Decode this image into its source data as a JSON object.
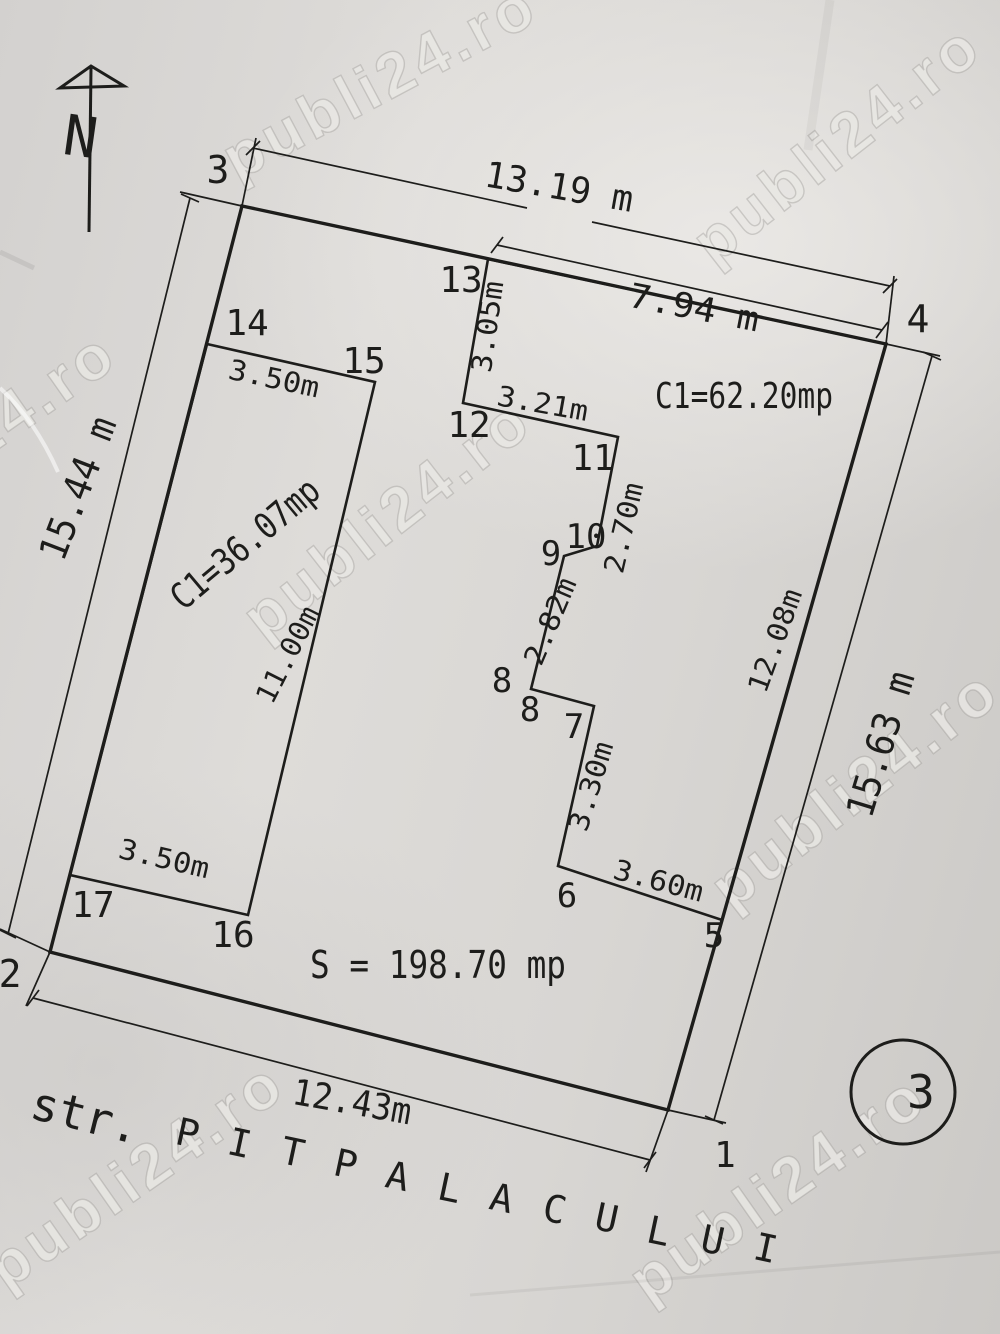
{
  "document_type": "cadastral site plan (scanned)",
  "colors": {
    "ink": "#1d1d1b",
    "paper": "#d8d6d3"
  },
  "watermark_text": "publi24.ro",
  "north_indicator": "N",
  "parcel": {
    "total_area_label": "S = 198.70 mp",
    "corner_numbers": [
      "1",
      "2",
      "3",
      "4"
    ],
    "side_dimensions": {
      "top": "13.19 m",
      "right": "15.63 m",
      "left": "15.44 m",
      "bottom": "12.43m"
    }
  },
  "buildings": [
    {
      "area_label": "C1=62.20mp",
      "corner_numbers": [
        "5",
        "6",
        "7",
        "8",
        "8",
        "9",
        "10",
        "11",
        "12",
        "13"
      ],
      "edge_dimensions": [
        "7.94 m",
        "12.08m",
        "3.60m",
        "3.30m",
        "2.82m",
        "2.70m",
        "3.21m",
        "3.05m"
      ]
    },
    {
      "area_label": "C1=36.07mp",
      "corner_numbers": [
        "14",
        "15",
        "16",
        "17"
      ],
      "edge_dimensions": [
        "3.50m",
        "11.00m",
        "3.50m"
      ]
    }
  ],
  "street": {
    "prefix": "str.",
    "name": "PITPALACULUI"
  },
  "sheet_number": "3",
  "street_letter_positions": [
    [
      185,
      1146
    ],
    [
      237,
      1156
    ],
    [
      290,
      1165
    ],
    [
      343,
      1177
    ],
    [
      395,
      1189
    ],
    [
      447,
      1201
    ],
    [
      499,
      1211
    ],
    [
      552,
      1222
    ],
    [
      604,
      1231
    ],
    [
      656,
      1244
    ],
    [
      710,
      1253
    ],
    [
      763,
      1261
    ]
  ],
  "street_letter_style": {
    "rot": 12,
    "size": 38
  },
  "annotations": [
    {
      "id": "north-letter",
      "t": "N",
      "x": 78,
      "y": 156,
      "r": 8,
      "s": 56
    },
    {
      "id": "corner-label-3",
      "t": "3",
      "x": 218,
      "y": 183,
      "r": 0,
      "s": 38
    },
    {
      "id": "dim-top",
      "t": "13.19 m",
      "x": 557,
      "y": 199,
      "r": 10,
      "s": 36,
      "tl": 150
    },
    {
      "id": "point-label-13",
      "t": "13",
      "x": 461,
      "y": 292,
      "r": 0,
      "s": 36
    },
    {
      "id": "dim-7-94",
      "t": "7.94 m",
      "x": 692,
      "y": 319,
      "r": 11,
      "s": 34,
      "tl": 132
    },
    {
      "id": "corner-label-4",
      "t": "4",
      "x": 918,
      "y": 332,
      "r": 0,
      "s": 38
    },
    {
      "id": "dim-3-05",
      "t": "3.05m",
      "x": 497,
      "y": 328,
      "r": -82,
      "s": 28,
      "tl": 92
    },
    {
      "id": "building-area-large",
      "t": "C1=62.20mp",
      "x": 744,
      "y": 408,
      "r": 0,
      "s": 36,
      "tl": 178
    },
    {
      "id": "point-label-12",
      "t": "12",
      "x": 469,
      "y": 437,
      "r": 0,
      "s": 36
    },
    {
      "id": "dim-3-21",
      "t": "3.21m",
      "x": 541,
      "y": 413,
      "r": 10,
      "s": 28,
      "tl": 92
    },
    {
      "id": "point-label-11",
      "t": "11",
      "x": 593,
      "y": 470,
      "r": 0,
      "s": 36
    },
    {
      "id": "dim-2-70",
      "t": "2.70m",
      "x": 633,
      "y": 530,
      "r": -77,
      "s": 28,
      "tl": 92
    },
    {
      "id": "point-label-10",
      "t": "10",
      "x": 586,
      "y": 548,
      "r": 0,
      "s": 34
    },
    {
      "id": "point-label-9",
      "t": "9",
      "x": 551,
      "y": 565,
      "r": 0,
      "s": 34
    },
    {
      "id": "dim-2-82",
      "t": "2.82m",
      "x": 559,
      "y": 625,
      "r": -67,
      "s": 28,
      "tl": 92
    },
    {
      "id": "point-label-8a",
      "t": "8",
      "x": 502,
      "y": 692,
      "r": 0,
      "s": 34
    },
    {
      "id": "point-label-8b",
      "t": "8",
      "x": 530,
      "y": 721,
      "r": 0,
      "s": 34
    },
    {
      "id": "point-label-7",
      "t": "7",
      "x": 574,
      "y": 738,
      "r": 0,
      "s": 34
    },
    {
      "id": "dim-3-30",
      "t": "3.30m",
      "x": 600,
      "y": 789,
      "r": -73,
      "s": 28,
      "tl": 92
    },
    {
      "id": "point-label-6",
      "t": "6",
      "x": 567,
      "y": 907,
      "r": 0,
      "s": 34
    },
    {
      "id": "dim-3-60",
      "t": "3.60m",
      "x": 656,
      "y": 890,
      "r": 15,
      "s": 28,
      "tl": 92
    },
    {
      "id": "point-label-5",
      "t": "5",
      "x": 714,
      "y": 947,
      "r": 0,
      "s": 34
    },
    {
      "id": "dim-12-08",
      "t": "12.08m",
      "x": 784,
      "y": 644,
      "r": -70,
      "s": 28,
      "tl": 108
    },
    {
      "id": "dim-right",
      "t": "15.63 m",
      "x": 893,
      "y": 748,
      "r": -73,
      "s": 38,
      "tl": 150
    },
    {
      "id": "dim-left",
      "t": "15.44 m",
      "x": 90,
      "y": 493,
      "r": -69,
      "s": 38,
      "tl": 150
    },
    {
      "id": "point-label-14",
      "t": "14",
      "x": 247,
      "y": 335,
      "r": 0,
      "s": 36
    },
    {
      "id": "dim-3-50-top",
      "t": "3.50m",
      "x": 272,
      "y": 388,
      "r": 12,
      "s": 28,
      "tl": 92
    },
    {
      "id": "point-label-15",
      "t": "15",
      "x": 364,
      "y": 373,
      "r": 0,
      "s": 36
    },
    {
      "id": "building-area-small",
      "t": "C1=36.07mp",
      "x": 253,
      "y": 553,
      "r": -40,
      "s": 36,
      "tl": 182
    },
    {
      "id": "dim-11-00",
      "t": "11.00m",
      "x": 296,
      "y": 659,
      "r": -63,
      "s": 28,
      "tl": 105
    },
    {
      "id": "dim-3-50-bottom",
      "t": "3.50m",
      "x": 162,
      "y": 868,
      "r": 13,
      "s": 28,
      "tl": 92
    },
    {
      "id": "point-label-17",
      "t": "17",
      "x": 93,
      "y": 917,
      "r": 0,
      "s": 36
    },
    {
      "id": "point-label-16",
      "t": "16",
      "x": 233,
      "y": 947,
      "r": 0,
      "s": 36
    },
    {
      "id": "total-area-label",
      "t": "S = 198.70 mp",
      "x": 438,
      "y": 978,
      "r": 0,
      "s": 38,
      "tl": 256
    },
    {
      "id": "corner-label-2",
      "t": "2",
      "x": 10,
      "y": 987,
      "r": 0,
      "s": 38
    },
    {
      "id": "dim-bottom",
      "t": "12.43m",
      "x": 350,
      "y": 1114,
      "r": 10,
      "s": 36,
      "tl": 120
    },
    {
      "id": "corner-label-1",
      "t": "1",
      "x": 725,
      "y": 1167,
      "r": 0,
      "s": 36
    },
    {
      "id": "street-prefix",
      "t": "str.",
      "x": 82,
      "y": 1131,
      "r": 14,
      "s": 46
    },
    {
      "id": "sheet-number",
      "t": "3",
      "x": 921,
      "y": 1108,
      "r": 0,
      "s": 46
    }
  ],
  "watermarks": [
    {
      "x": 390,
      "y": 100,
      "r": -28
    },
    {
      "x": 850,
      "y": 160,
      "r": -38
    },
    {
      "x": -20,
      "y": 462,
      "r": -35
    },
    {
      "x": 400,
      "y": 535,
      "r": -38
    },
    {
      "x": 868,
      "y": 805,
      "r": -38
    },
    {
      "x": 148,
      "y": 1192,
      "r": -35
    },
    {
      "x": 790,
      "y": 1205,
      "r": -35
    }
  ]
}
